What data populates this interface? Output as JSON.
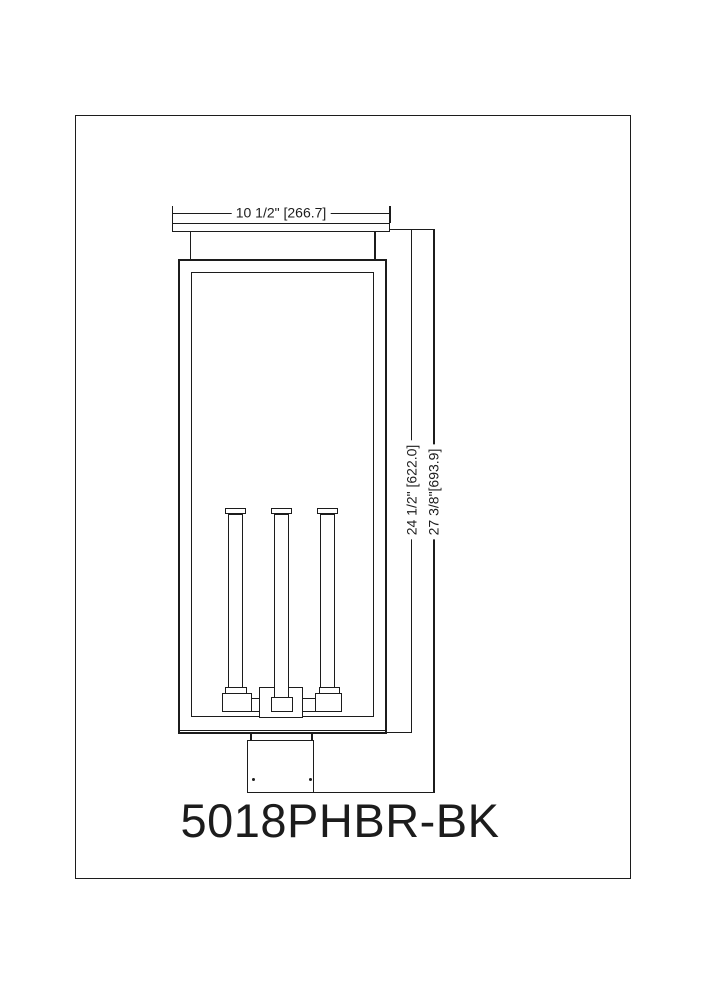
{
  "model_number": "5018PHBR-BK",
  "dimensions": {
    "width_label": "10 1/2\" [266.7]",
    "body_height_label": "24 1/2\" [622.0]",
    "overall_height_label": "27 3/8\"[693.9]"
  },
  "colors": {
    "ink": "#1c1c1c",
    "paper": "#ffffff"
  }
}
